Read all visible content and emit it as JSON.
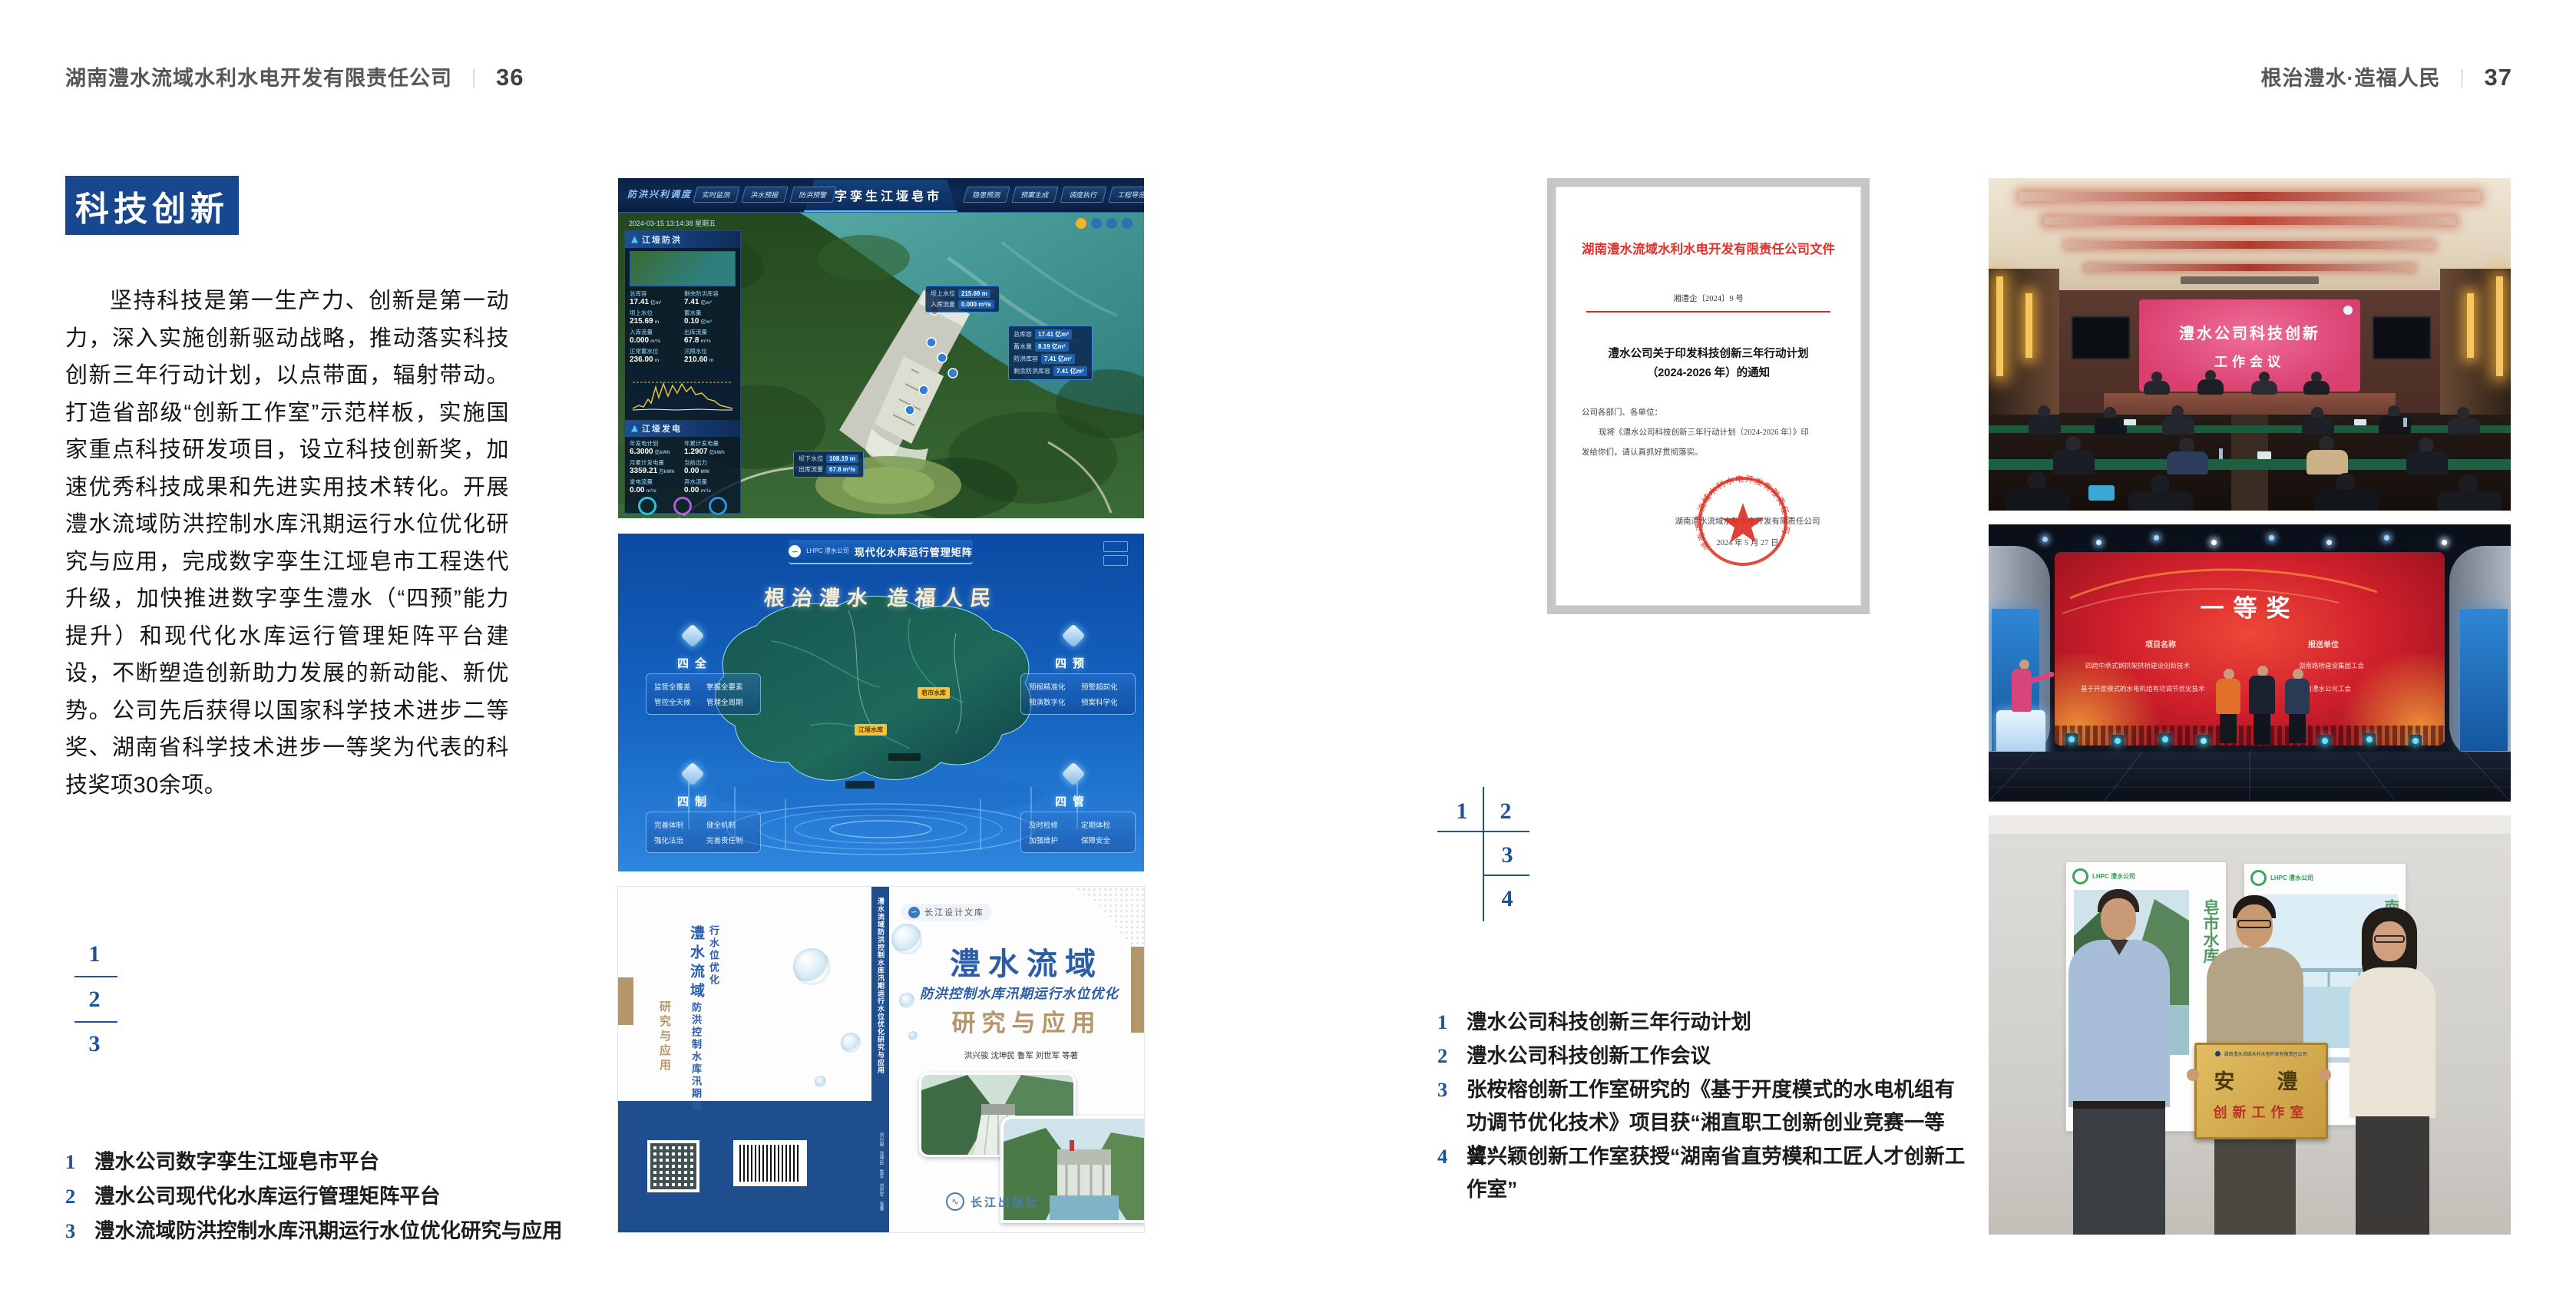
{
  "left": {
    "header_title": "湖南澧水流域水利水电开发有限责任公司",
    "header_divider": "｜",
    "header_page": "36",
    "badge": "科技创新",
    "paragraph": "坚持科技是第一生产力、创新是第一动力，深入实施创新驱动战略，推动落实科技创新三年行动计划，以点带面，辐射带动。打造省部级“创新工作室”示范样板，实施国家重点科技研发项目，设立科技创新奖，加速优秀科技成果和先进实用技术转化。开展澧水流域防洪控制水库汛期运行水位优化研究与应用，完成数字孪生江垭皂市工程迭代升级，加快推进数字孪生澧水（“四预”能力提升）和现代化水库运行管理矩阵平台建设，不断塑造创新助力发展的新动能、新优势。公司先后获得以国家科学技术进步二等奖、湖南省科学技术进步一等奖为代表的科技奖项30余项。",
    "fig_index": [
      "1",
      "2",
      "3"
    ],
    "captions": [
      {
        "no": "1",
        "text": "澧水公司数字孪生江垭皂市平台"
      },
      {
        "no": "2",
        "text": "澧水公司现代化水库运行管理矩阵平台"
      },
      {
        "no": "3",
        "text": "澧水流域防洪控制水库汛期运行水位优化研究与应用"
      }
    ]
  },
  "right": {
    "header_title": "根治澧水·造福人民",
    "header_divider": "｜",
    "header_page": "37",
    "fig_index": [
      "1",
      "2",
      "3",
      "4"
    ],
    "captions": [
      {
        "no": "1",
        "text": "澧水公司科技创新三年行动计划"
      },
      {
        "no": "2",
        "text": "澧水公司科技创新工作会议"
      },
      {
        "no": "3",
        "text": "张桉榕创新工作室研究的《基于开度模式的水电机组有功调节优化技术》项目获“湘直职工创新创业竞赛一等奖”"
      },
      {
        "no": "4",
        "text": "曾兴颖创新工作室获授“湖南省直劳模和工匠人才创新工作室”"
      }
    ]
  },
  "twin": {
    "system_label": "防洪兴利调度",
    "title": "数字孪生江垭皂市",
    "tabs_left": [
      "实时监测",
      "洪水预报",
      "防洪预警"
    ],
    "tabs_right": [
      "隐患预测",
      "预案生成",
      "调度执行",
      "工程导览"
    ],
    "datetime": "2024-03-15 13:14:38 星期五",
    "panel_flood": {
      "title": "江垭防洪",
      "metrics": [
        {
          "label": "总库容",
          "value": "17.41",
          "unit": "亿m³"
        },
        {
          "label": "剩余防洪库容",
          "value": "7.41",
          "unit": "亿m³"
        },
        {
          "label": "坝上水位",
          "value": "215.69",
          "unit": "m"
        },
        {
          "label": "蓄水量",
          "value": "0.10",
          "unit": "亿m³"
        },
        {
          "label": "入库流量",
          "value": "0.000",
          "unit": "m³/s"
        },
        {
          "label": "出库流量",
          "value": "67.8",
          "unit": "m³/s"
        },
        {
          "label": "正常蓄水位",
          "value": "236.00",
          "unit": "m"
        },
        {
          "label": "汛限水位",
          "value": "210.60",
          "unit": "m"
        }
      ]
    },
    "panel_power": {
      "title": "江垭发电",
      "metrics": [
        {
          "label": "年发电计划",
          "value": "6.3000",
          "unit": "亿kWh"
        },
        {
          "label": "年累计发电量",
          "value": "1.2907",
          "unit": "亿kWh"
        },
        {
          "label": "月累计发电量",
          "value": "3359.21",
          "unit": "万kWh"
        },
        {
          "label": "当前出力",
          "value": "0.00",
          "unit": "MW"
        },
        {
          "label": "发电流量",
          "value": "0.00",
          "unit": "m³/s"
        },
        {
          "label": "弃水流量",
          "value": "0.00",
          "unit": "m³/s"
        }
      ],
      "units": [
        "1号机组",
        "2号机组",
        "3号机组"
      ]
    },
    "callout_up": [
      {
        "label": "坝上水位",
        "value": "215.69 m"
      },
      {
        "label": "入库流量",
        "value": "0.000 m³/s"
      }
    ],
    "callout_info": [
      {
        "label": "总库容",
        "value": "17.41 亿m³"
      },
      {
        "label": "蓄水量",
        "value": "8.19 亿m³"
      },
      {
        "label": "防洪库容",
        "value": "7.41 亿m³"
      },
      {
        "label": "剩余防洪库容",
        "value": "7.41 亿m³"
      }
    ],
    "callout_down": [
      {
        "label": "坝下水位",
        "value": "108.19 m"
      },
      {
        "label": "出库流量",
        "value": "67.8 m³/s"
      }
    ]
  },
  "matrix": {
    "logo_text": "LHPC 澧水公司",
    "title": "现代化水库运行管理矩阵",
    "slogan": "根治澧水  造福人民",
    "panels": [
      {
        "title": "四全",
        "items": [
          "监管全覆盖",
          "掌握全要素",
          "管控全天候",
          "管理全周期"
        ]
      },
      {
        "title": "四预",
        "items": [
          "预报精准化",
          "预警超前化",
          "预演数字化",
          "预案科学化"
        ]
      },
      {
        "title": "四制",
        "items": [
          "完善体制",
          "健全机制",
          "强化法治",
          "完善责任制"
        ]
      },
      {
        "title": "四管",
        "items": [
          "及时检修",
          "定期体检",
          "加强维护",
          "保障安全"
        ]
      }
    ],
    "markers": [
      "皂市水库",
      "江垭水库"
    ]
  },
  "book": {
    "library_badge": "长江设计文库",
    "title_main": "澧水流域",
    "title_sub": "防洪控制水库汛期运行水位优化",
    "title_tail": "研究与应用",
    "authors": "洪兴骏  沈坤民  鲁军  刘世军  等著",
    "publisher": "长江出版社",
    "spine_title": "澧水流域防洪控制水库汛期运行水位优化研究与应用"
  },
  "doc": {
    "header": "湖南澧水流域水利水电开发有限责任公司文件",
    "doc_no": "湘澧企〔2024〕9 号",
    "title_line1": "澧水公司关于印发科技创新三年行动计划",
    "title_line2": "（2024-2026 年）的通知",
    "salutation": "公司各部门、各单位：",
    "body_line1": "现将《澧水公司科技创新三年行动计划（2024-2026 年）》印",
    "body_line2": "发给你们，请认真抓好贯彻落实。",
    "signer": "湖南澧水流域水利水电开发有限责任公司",
    "date": "2024 年 5 月 27 日",
    "seal_text": "湖南澧水流域水利水电开发有限责任公司"
  },
  "meeting": {
    "screen_line1": "澧水公司科技创新",
    "screen_line2": "工作会议"
  },
  "award": {
    "title": "一等奖",
    "col1_header": "项目名称",
    "col2_header": "报送单位",
    "rows": [
      {
        "project": "四跨中承式钢拱架拱桥建设创新技术",
        "org": "湖南路桥建设集团工会"
      },
      {
        "project": "基于开度模式的水电机组有功调节优化技术",
        "org": "湖南澧水公司工会"
      }
    ]
  },
  "group": {
    "poster1_logo": "LHPC 澧水公司",
    "poster1_caption": "皂市水库",
    "poster2_logo": "LHPC 澧水公司",
    "poster2_caption": "南水北调",
    "plaque_header": "湖南澧水流域水利水电开发有限责任公司",
    "plaque_title": "安　澧",
    "plaque_sub": "创新工作室"
  },
  "colors": {
    "accent_blue": "#17478e",
    "caption_blue": "#1d5198",
    "doc_red": "#e0302a",
    "book_tan": "#b5956a",
    "band_blue": "#1f4e8f"
  }
}
